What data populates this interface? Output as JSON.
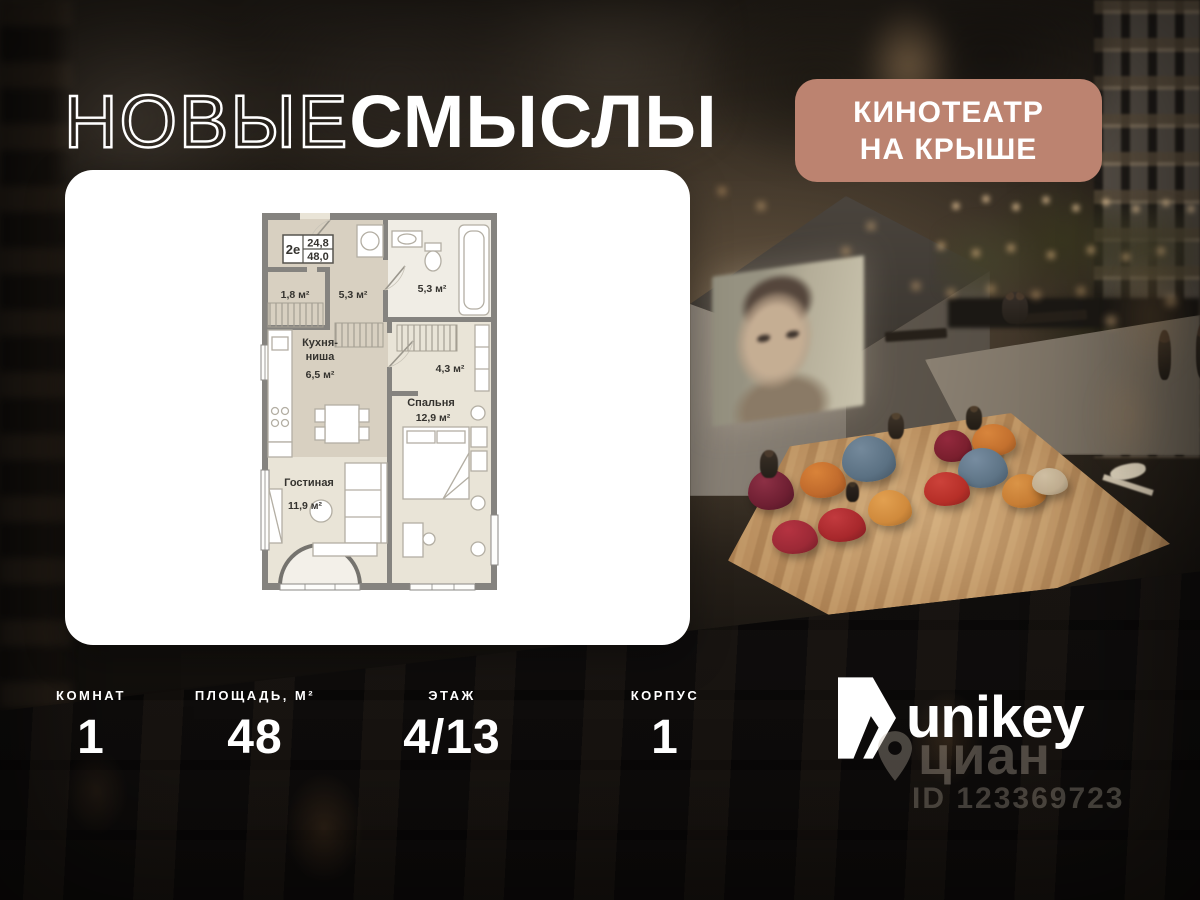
{
  "brand": {
    "logo_thin": "НОВЫЕ",
    "logo_bold": "СМЫСЛЫ"
  },
  "badge": {
    "line1": "КИНОТЕАТР",
    "line2": "НА КРЫШЕ"
  },
  "floorplan": {
    "unit_type": "2е",
    "area_living": "24,8",
    "area_total": "48,0",
    "labels": {
      "closet_area": "1,8 м²",
      "hall_area": "5,3 м²",
      "bath_area": "5,3 м²",
      "kitchen_name_1": "Кухня-",
      "kitchen_name_2": "ниша",
      "kitchen_area": "6,5 м²",
      "wardrobe_area": "4,3 м²",
      "bedroom_name": "Спальня",
      "bedroom_area": "12,9 м²",
      "living_name": "Гостиная",
      "living_area": "11,9 м²"
    }
  },
  "stats": [
    {
      "label": "КОМНАТ",
      "value": "1"
    },
    {
      "label": "ПЛОЩАДЬ, М²",
      "value": "48"
    },
    {
      "label": "ЭТАЖ",
      "value": "4/13"
    },
    {
      "label": "КОРПУС",
      "value": "1"
    }
  ],
  "developer": {
    "name": "unikey"
  },
  "watermark": {
    "brand": "циан",
    "listing_id": "ID 123369723"
  },
  "colors": {
    "badge_bg": "#bc8370",
    "card_bg": "#ffffff"
  }
}
